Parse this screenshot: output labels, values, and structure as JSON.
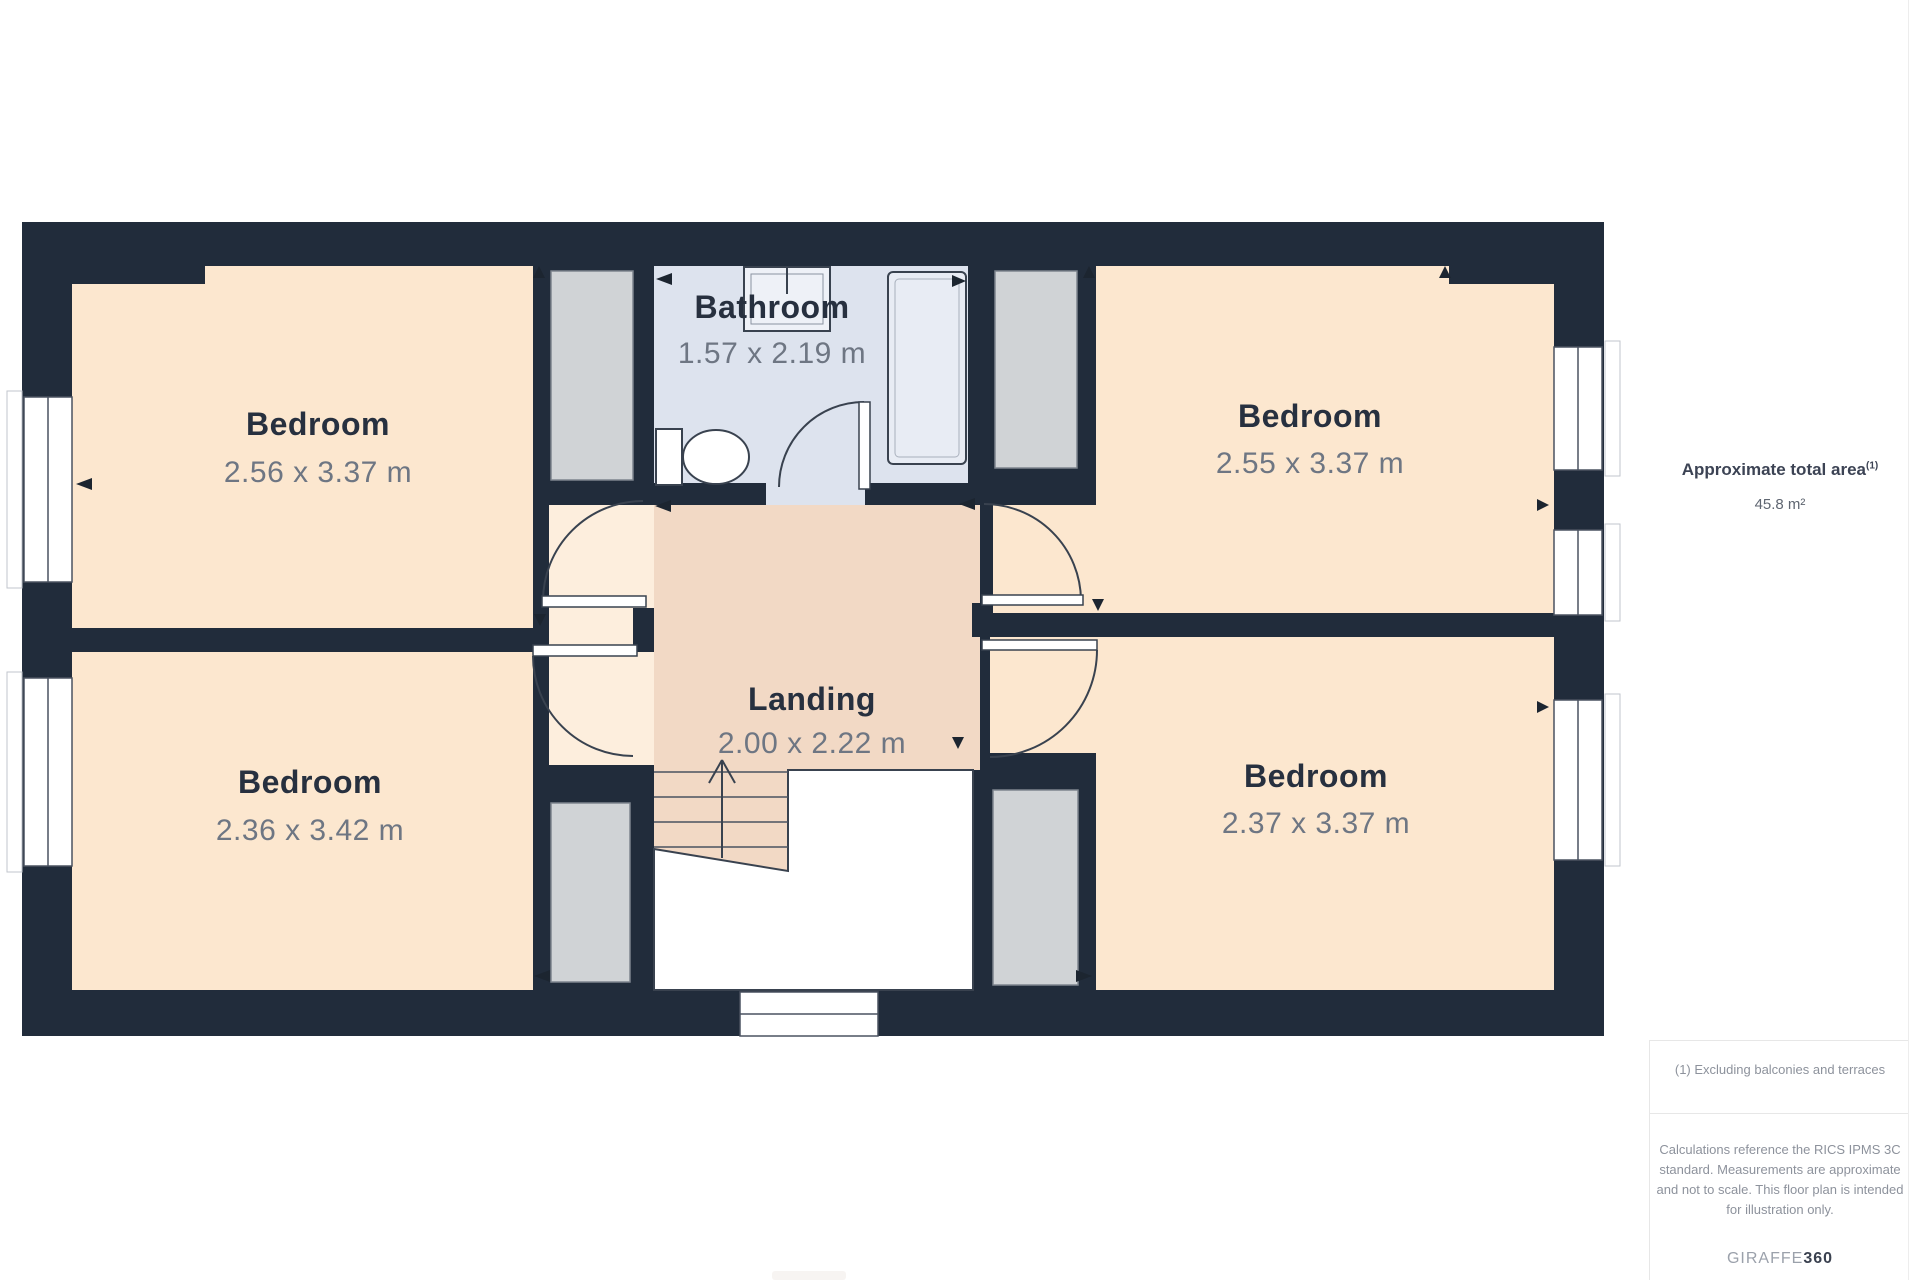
{
  "plan": {
    "rooms": [
      {
        "id": "bedroom-top-left",
        "name": "Bedroom",
        "dims": "2.56 x 3.37 m"
      },
      {
        "id": "bedroom-top-right",
        "name": "Bedroom",
        "dims": "2.55 x 3.37 m"
      },
      {
        "id": "bedroom-bottom-left",
        "name": "Bedroom",
        "dims": "2.36 x 3.42 m"
      },
      {
        "id": "bedroom-bottom-right",
        "name": "Bedroom",
        "dims": "2.37 x 3.37 m"
      },
      {
        "id": "bathroom",
        "name": "Bathroom",
        "dims": "1.57 x 2.19 m"
      },
      {
        "id": "landing",
        "name": "Landing",
        "dims": "2.00 x 2.22 m"
      }
    ],
    "colors": {
      "wall": "#212c3b",
      "bedroom_floor": "#fce7cf",
      "hall_floor": "#fdeedd",
      "landing_floor": "#f2d9c5",
      "bathroom_floor": "#dde3ee",
      "closet": "#d0d3d6"
    }
  },
  "sidebar": {
    "total_area_label": "Approximate total area",
    "total_area_marker": "(1)",
    "total_area_value": "45.8 m²",
    "footnote": "(1) Excluding balconies and terraces",
    "disclaimer": "Calculations reference the RICS IPMS 3C standard. Measurements are approximate and not to scale. This floor plan is intended for illustration only.",
    "brand_primary": "GIRAFFE",
    "brand_secondary": "360"
  }
}
